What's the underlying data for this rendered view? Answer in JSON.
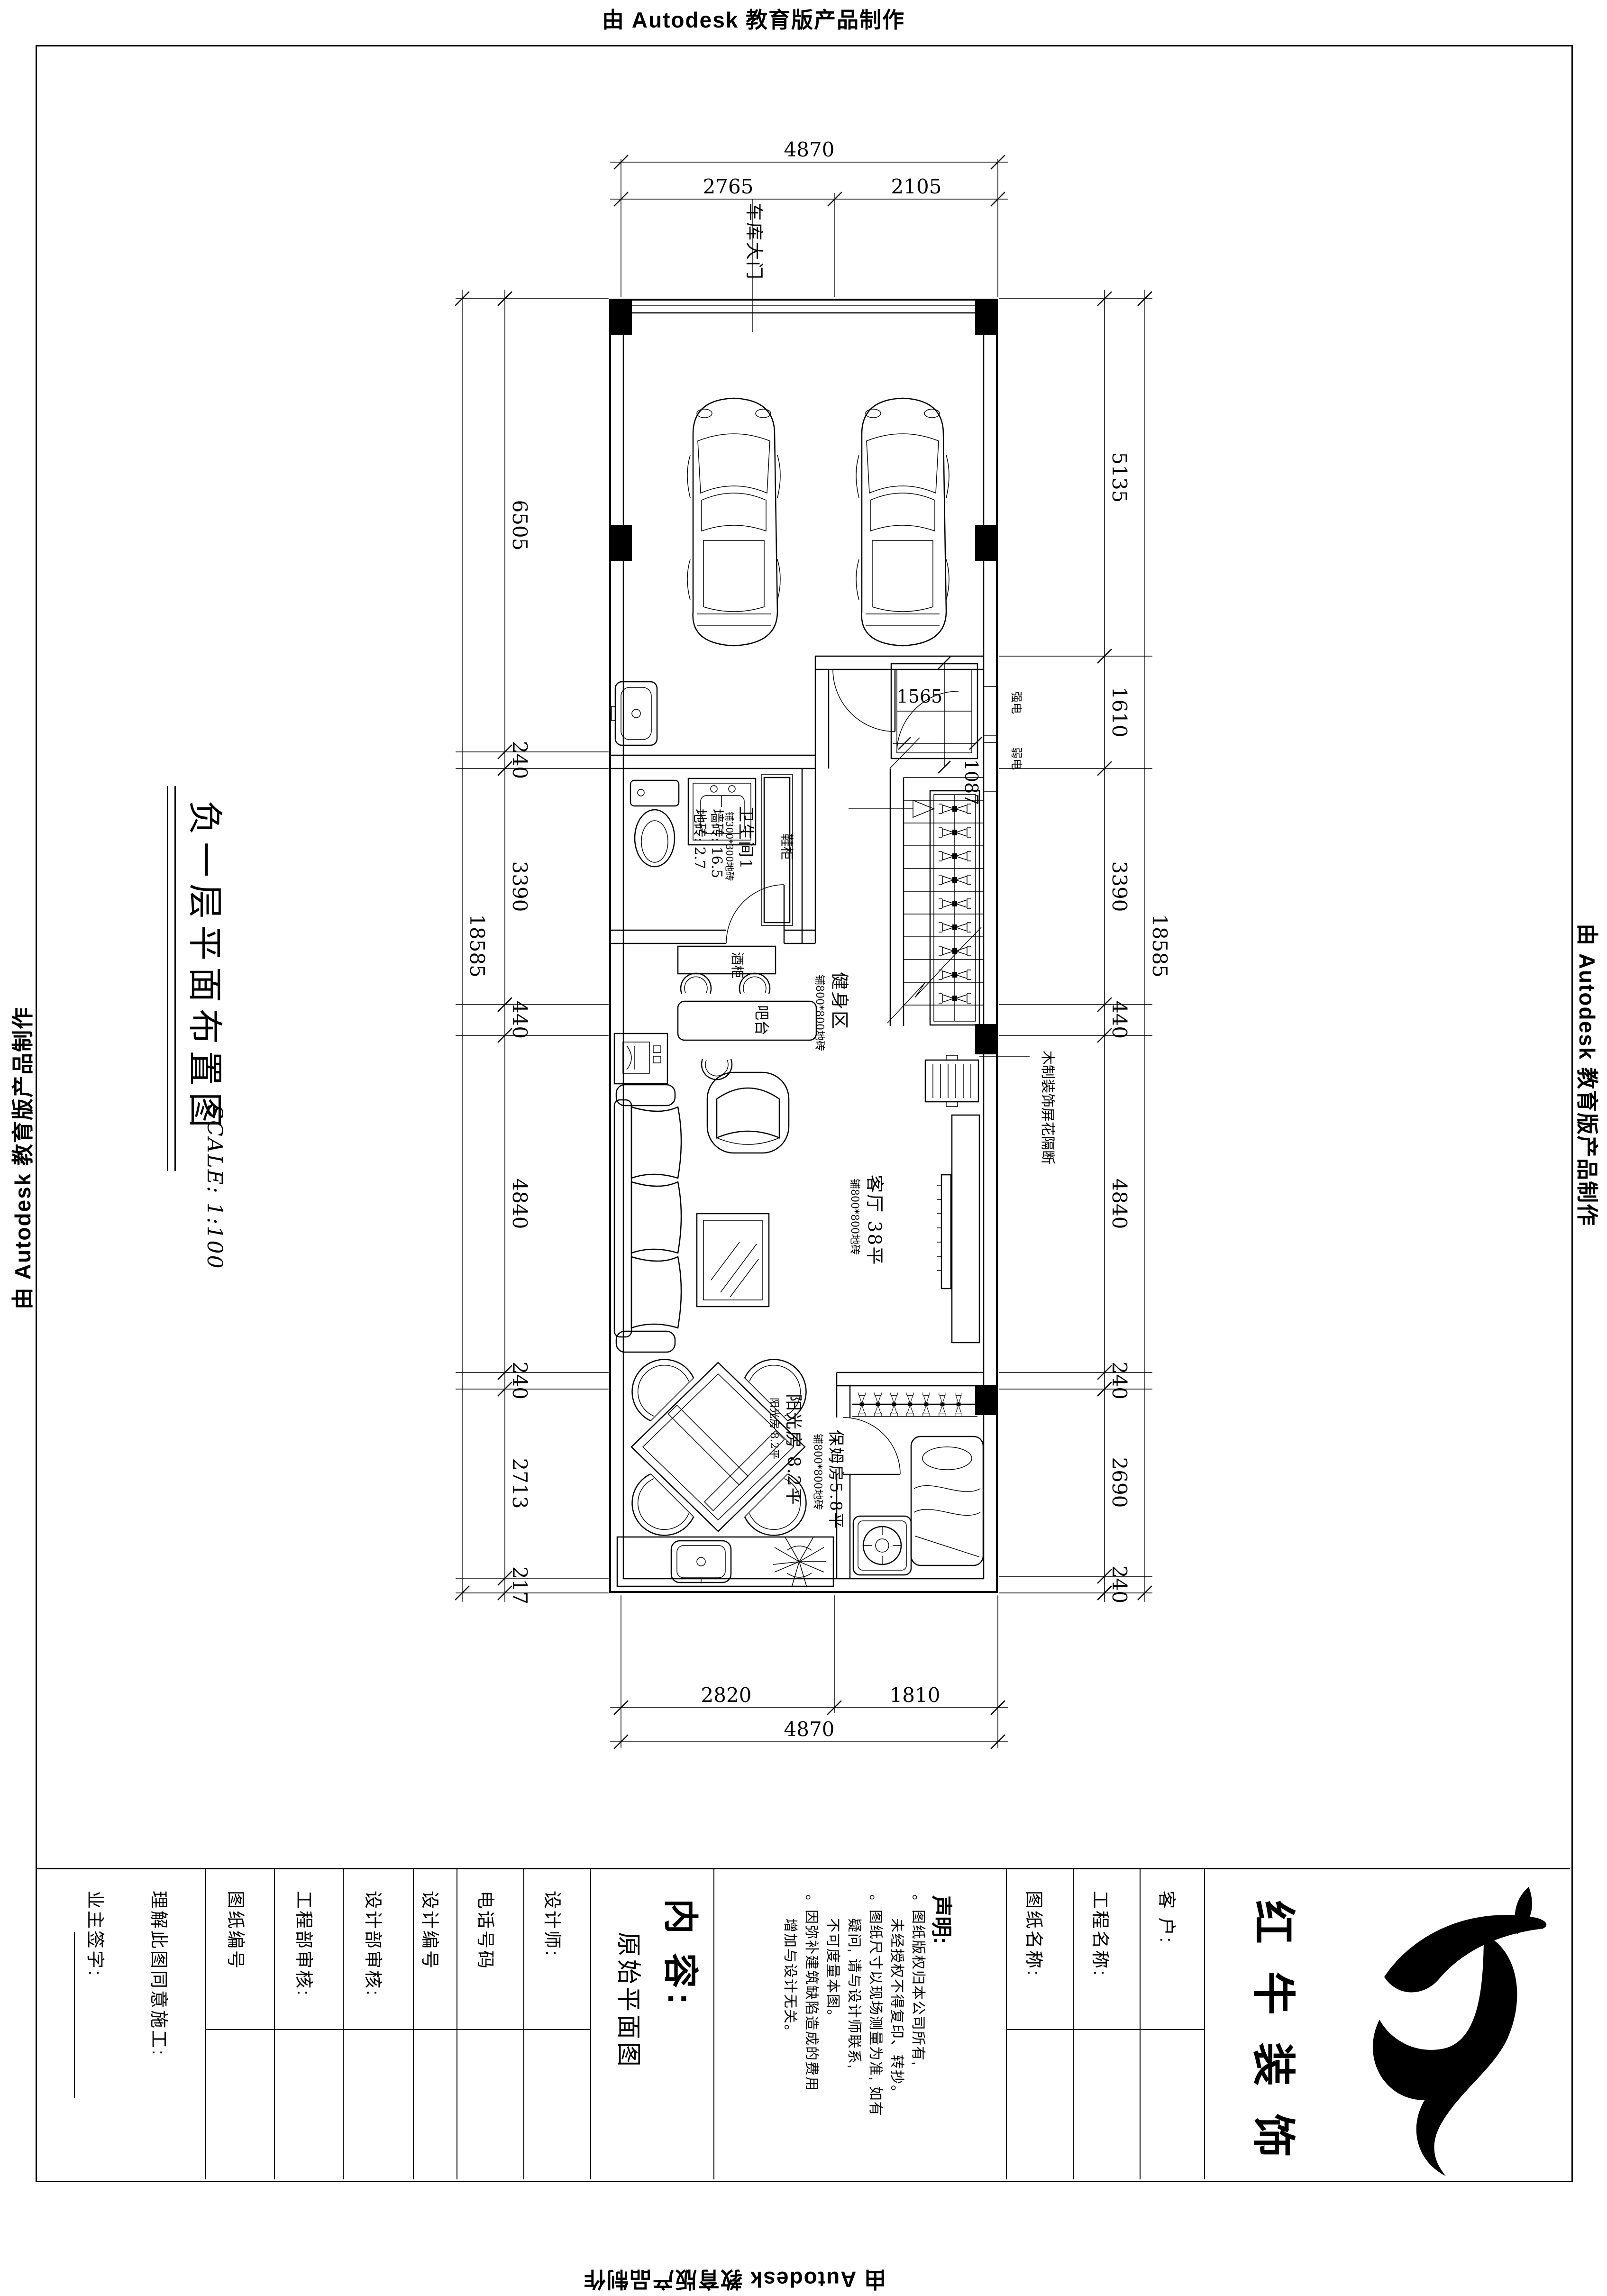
{
  "stamps": {
    "top": "由 Autodesk 教育版产品制作",
    "right": "由 Autodesk 教育版产品制作",
    "bottom": "由 Autodesk 教育版产品制作",
    "left": "由 Autodesk 教育版产品制作"
  },
  "sheet": {
    "title": "负一层平面布置图",
    "scale": "SCALE: 1:100"
  },
  "plan": {
    "labels": {
      "garage_door": "车库大门",
      "bathroom": "卫生间1",
      "bathroom_note_small": "铺300*300地砖",
      "bathroom_note1": "墙砖: 16.5",
      "bathroom_note2": "地砖: 2.7",
      "shoe_cabinet": "鞋柜",
      "wine_cabinet": "酒柜",
      "bar": "吧台",
      "fitness": "健身区",
      "fitness_note": "铺800*800地砖",
      "living": "客厅 38平",
      "living_note": "铺800*800地砖",
      "sunroom": "阳光房  8.2平",
      "sunroom_note": "铺800*800地砖",
      "nanny": "保姆房5.8平",
      "nanny_note": "铺800*800地砖",
      "screen": "木制装饰屏花隔断",
      "power_strong": "强电",
      "power_weak": "弱电"
    },
    "dims": {
      "top_total": "4870",
      "top_left": "2765",
      "top_right": "2105",
      "bottom_left": "2820",
      "bottom_right": "1810",
      "bottom_total": "4870",
      "left_total": "18585",
      "left_chain": [
        "6505",
        "240",
        "3390",
        "440",
        "4840",
        "240",
        "2713",
        "217"
      ],
      "right_chain": [
        "5135",
        "1610",
        "3390",
        "440",
        "4840",
        "240",
        "2690",
        "240"
      ],
      "right_total": "18585",
      "entry_w": "1565",
      "entry_h": "1087"
    }
  },
  "titleblock": {
    "owner_sign": "业主签字:",
    "agree": "理解此图同意施工:",
    "drawing_no": "图纸编号",
    "eng_review": "工程部审核:",
    "design_review": "设计部审核:",
    "design_no": "设计编号",
    "phone": "电话号码",
    "designer": "设计师:",
    "content_label": "内 容:",
    "content_value": "原始平面图",
    "notice_title": "声明:",
    "notice_lines": [
      "。图纸版权归本公司所有,",
      "未经授权不得复印、转抄。",
      "。图纸尺寸以现场测量为准, 如有",
      "疑问, 请与设计师联系,",
      "不可度量本图。",
      "。因弥补建筑缺陷造成的费用",
      "增加与设计无关。"
    ],
    "sheet_name": "图纸名称:",
    "project_name": "工程名称:",
    "client": "客  户:",
    "brand": [
      "红",
      "牛",
      "装",
      "饰"
    ]
  }
}
